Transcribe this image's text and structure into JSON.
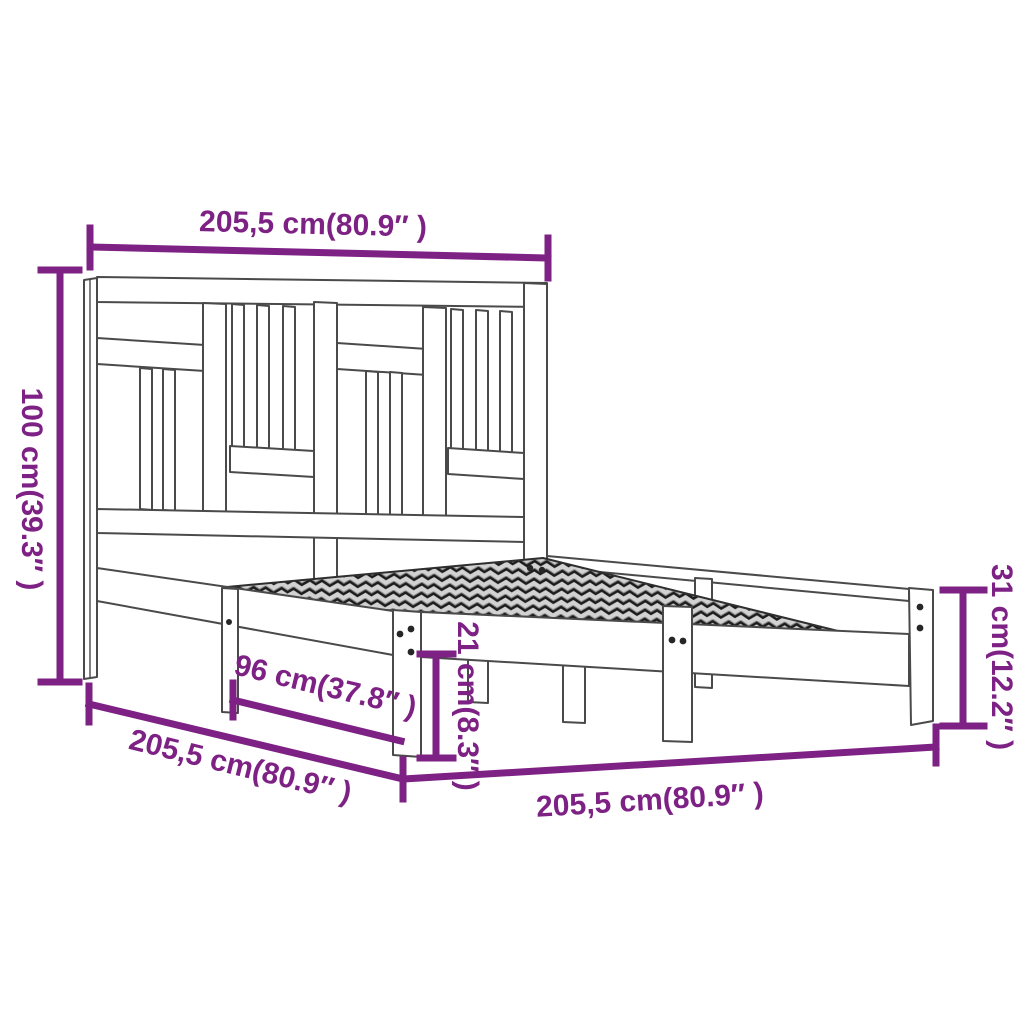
{
  "diagram": {
    "dimensions": {
      "headboard_width": "205,5 cm(80.9″ )",
      "headboard_height": "100 cm(39.3″ )",
      "side_length": "205,5 cm(80.9″ )",
      "rail_length": "96 cm(37.8″ )",
      "base_height": "21 cm(8.3″ )",
      "foot_width": "205,5 cm(80.9″ )",
      "corner_height": "31 cm(12.2″ )"
    },
    "colors": {
      "dimension": "#7e2185",
      "drawing": "#4a4a4a",
      "screw": "#262626",
      "background": "#ffffff"
    }
  }
}
